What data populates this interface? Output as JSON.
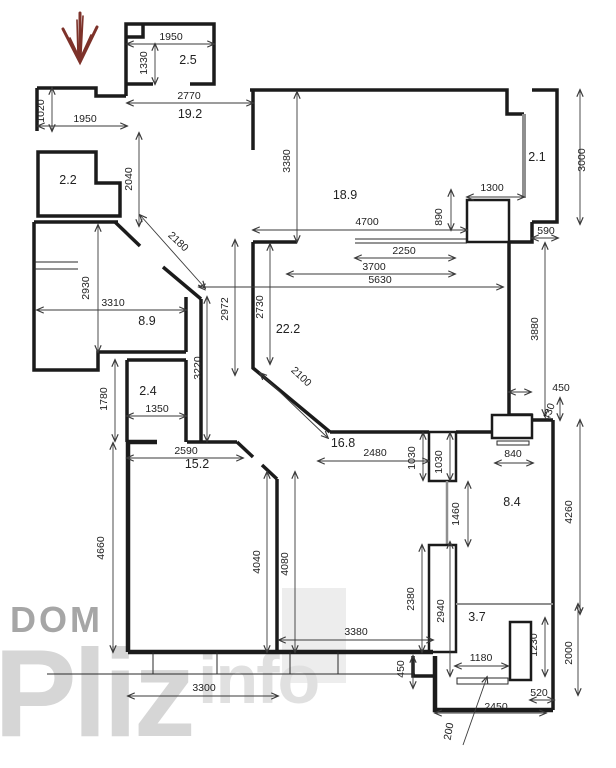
{
  "title": "apartment floor plan with dimensions",
  "colors": {
    "wall": "#1b1b1b",
    "dimension_line": "#3a3a3a",
    "glass_partition": "#8f8f8f",
    "entrance_arrow": "#7d322a",
    "watermark": "#cfcfcf"
  },
  "watermark": {
    "dom": "DOM",
    "pliz": "Pliz",
    "info": "info"
  },
  "rooms": [
    {
      "label": "2.5",
      "x": 188,
      "y": 64
    },
    {
      "label": "19.2",
      "x": 190,
      "y": 118
    },
    {
      "label": "2.2",
      "x": 68,
      "y": 184
    },
    {
      "label": "18.9",
      "x": 345,
      "y": 199
    },
    {
      "label": "2.1",
      "x": 537,
      "y": 161
    },
    {
      "label": "8.9",
      "x": 147,
      "y": 325
    },
    {
      "label": "22.2",
      "x": 288,
      "y": 333
    },
    {
      "label": "2.4",
      "x": 148,
      "y": 395
    },
    {
      "label": "15.2",
      "x": 197,
      "y": 468
    },
    {
      "label": "16.8",
      "x": 343,
      "y": 447
    },
    {
      "label": "8.4",
      "x": 512,
      "y": 506
    },
    {
      "label": "3.7",
      "x": 477,
      "y": 621
    },
    {
      "label": "Pliz",
      "x": -500,
      "y": -500
    }
  ],
  "dimensions": [
    {
      "text": "1950",
      "x": 171,
      "y": 40,
      "rot": 0
    },
    {
      "text": "1330",
      "x": 147,
      "y": 63,
      "rot": -90
    },
    {
      "text": "2770",
      "x": 189,
      "y": 99,
      "rot": 0
    },
    {
      "text": "1020",
      "x": 44,
      "y": 111,
      "rot": -90
    },
    {
      "text": "1950",
      "x": 85,
      "y": 122,
      "rot": 0
    },
    {
      "text": "2040",
      "x": 132,
      "y": 179,
      "rot": -90
    },
    {
      "text": "2180",
      "x": 176,
      "y": 244,
      "rot": 43
    },
    {
      "text": "2930",
      "x": 89,
      "y": 288,
      "rot": -90
    },
    {
      "text": "3310",
      "x": 113,
      "y": 306,
      "rot": 0
    },
    {
      "text": "3220",
      "x": 201,
      "y": 368,
      "rot": -90
    },
    {
      "text": "1780",
      "x": 107,
      "y": 399,
      "rot": -90
    },
    {
      "text": "1350",
      "x": 157,
      "y": 412,
      "rot": 0
    },
    {
      "text": "2590",
      "x": 186,
      "y": 454,
      "rot": 0
    },
    {
      "text": "4660",
      "x": 104,
      "y": 548,
      "rot": -90
    },
    {
      "text": "3300",
      "x": 204,
      "y": 691,
      "rot": 0
    },
    {
      "text": "3380",
      "x": 290,
      "y": 161,
      "rot": -90
    },
    {
      "text": "4700",
      "x": 367,
      "y": 225,
      "rot": 0
    },
    {
      "text": "890",
      "x": 442,
      "y": 217,
      "rot": -90
    },
    {
      "text": "1300",
      "x": 492,
      "y": 191,
      "rot": 0
    },
    {
      "text": "3000",
      "x": 585,
      "y": 160,
      "rot": -90
    },
    {
      "text": "590",
      "x": 546,
      "y": 234,
      "rot": 0
    },
    {
      "text": "2250",
      "x": 404,
      "y": 254,
      "rot": 0
    },
    {
      "text": "3700",
      "x": 374,
      "y": 270,
      "rot": 0
    },
    {
      "text": "5630",
      "x": 380,
      "y": 283,
      "rot": 0
    },
    {
      "text": "2972",
      "x": 228,
      "y": 309,
      "rot": -90
    },
    {
      "text": "2730",
      "x": 263,
      "y": 307,
      "rot": -90
    },
    {
      "text": "2100",
      "x": 299,
      "y": 379,
      "rot": 43
    },
    {
      "text": "3880",
      "x": 538,
      "y": 329,
      "rot": -90
    },
    {
      "text": "450",
      "x": 561,
      "y": 391,
      "rot": 0
    },
    {
      "text": "430",
      "x": 552,
      "y": 413,
      "rot": -70
    },
    {
      "text": "840",
      "x": 513,
      "y": 457,
      "rot": 0
    },
    {
      "text": "2480",
      "x": 375,
      "y": 456,
      "rot": 0
    },
    {
      "text": "1030",
      "x": 415,
      "y": 458,
      "rot": -90
    },
    {
      "text": "1030",
      "x": 442,
      "y": 462,
      "rot": -90
    },
    {
      "text": "1460",
      "x": 459,
      "y": 514,
      "rot": -90
    },
    {
      "text": "4260",
      "x": 572,
      "y": 512,
      "rot": -90
    },
    {
      "text": "4040",
      "x": 260,
      "y": 562,
      "rot": -90
    },
    {
      "text": "4080",
      "x": 288,
      "y": 564,
      "rot": -90
    },
    {
      "text": "2380",
      "x": 414,
      "y": 599,
      "rot": -90
    },
    {
      "text": "2940",
      "x": 444,
      "y": 611,
      "rot": -90
    },
    {
      "text": "3380",
      "x": 356,
      "y": 635,
      "rot": 0
    },
    {
      "text": "1180",
      "x": 481,
      "y": 661,
      "rot": 0
    },
    {
      "text": "1230",
      "x": 537,
      "y": 645,
      "rot": -90
    },
    {
      "text": "2000",
      "x": 572,
      "y": 653,
      "rot": -90
    },
    {
      "text": "450",
      "x": 404,
      "y": 669,
      "rot": -90
    },
    {
      "text": "520",
      "x": 539,
      "y": 696,
      "rot": 0
    },
    {
      "text": "2450",
      "x": 496,
      "y": 710,
      "rot": 0
    },
    {
      "text": "200",
      "x": 452,
      "y": 732,
      "rot": -80
    }
  ]
}
